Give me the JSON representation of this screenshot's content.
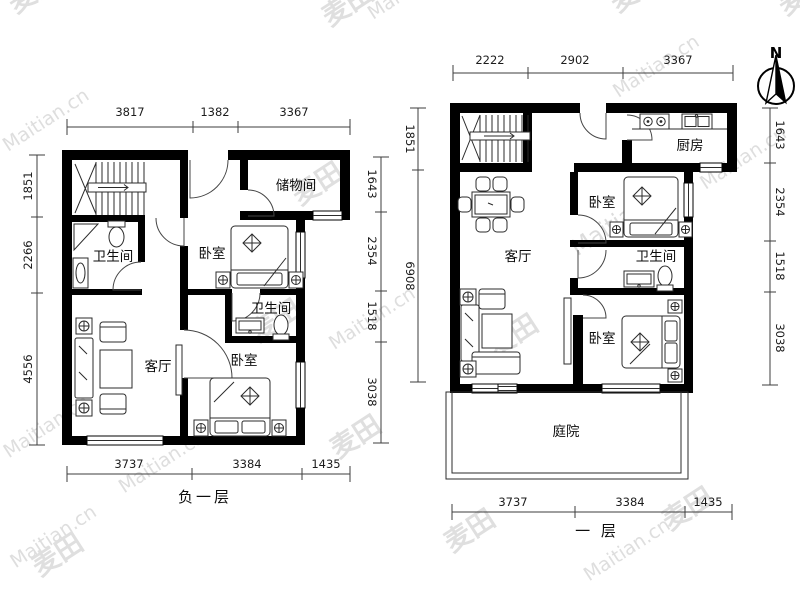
{
  "compass": {
    "north_label": "N"
  },
  "watermark": {
    "brand": "Maitian.cn",
    "logo": "麦田"
  },
  "colors": {
    "wall": "#000000",
    "dimension_line": "#3d3d3d",
    "watermark": "#b3b3b3"
  },
  "plans": [
    {
      "id": "basement",
      "title": "负一层",
      "rooms": {
        "storage": "储物间",
        "bath_upper": "卫生间",
        "bed_upper": "卧室",
        "bath_lower": "卫生间",
        "living": "客厅",
        "bed_lower": "卧室"
      },
      "dims": {
        "top": [
          "3817",
          "1382",
          "3367"
        ],
        "left": [
          "1851",
          "2266",
          "4556"
        ],
        "right": [
          "1643",
          "2354",
          "1518",
          "3038"
        ],
        "bottom": [
          "3737",
          "3384",
          "1435"
        ]
      }
    },
    {
      "id": "first-floor",
      "title": "一 层",
      "rooms": {
        "kitchen": "厨房",
        "bed_upper": "卧室",
        "living": "客厅",
        "bath": "卫生间",
        "bed_lower": "卧室",
        "courtyard": "庭院"
      },
      "dims": {
        "top": [
          "2222",
          "2902",
          "3367"
        ],
        "left": [
          "1851",
          "6908"
        ],
        "right": [
          "1643",
          "2354",
          "1518",
          "3038"
        ],
        "bottom": [
          "3737",
          "3384",
          "1435"
        ]
      }
    }
  ]
}
